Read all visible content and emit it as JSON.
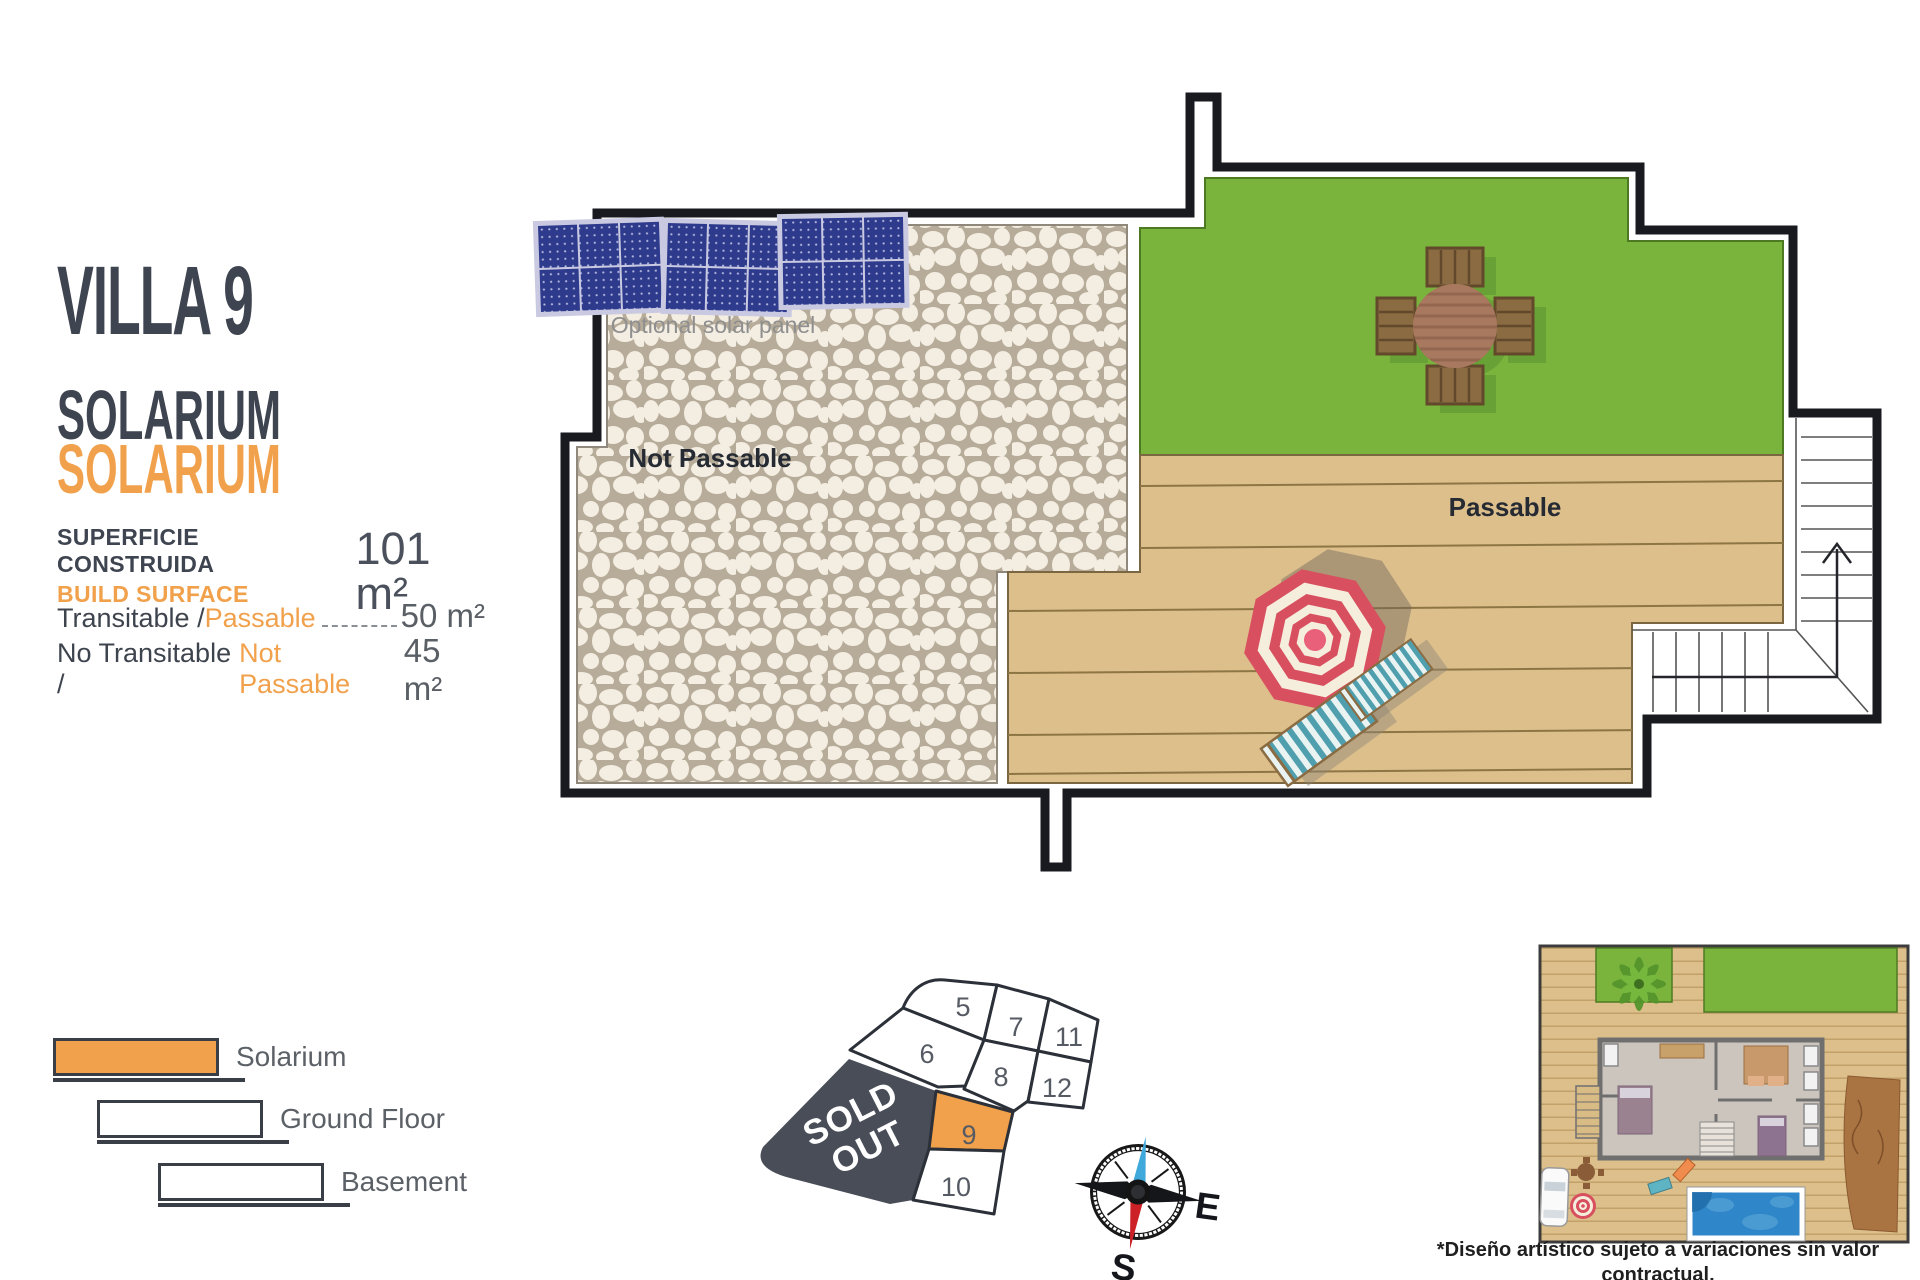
{
  "info_panel": {
    "title": "VILLA 9",
    "subtitle_primary": "SOLARIUM",
    "subtitle_accent": "SOLARIUM",
    "build_surface_label_es": "SUPERFICIE CONSTRUIDA",
    "build_surface_label_en": "BUILD SURFACE",
    "build_surface_value": "101 m²",
    "areas": [
      {
        "label_es": "Transitable / ",
        "label_en": "Passable",
        "value": "50 m²"
      },
      {
        "label_es": "No Transitable / ",
        "label_en": "Not Passable",
        "value": "45 m²"
      }
    ]
  },
  "floor_plan": {
    "optional_solar_panel_label": "Optional solar panel",
    "not_passable_label": "Not Passable",
    "passable_label": "Passable"
  },
  "legend": {
    "items": [
      {
        "label": "Solarium",
        "filled": true
      },
      {
        "label": "Ground Floor",
        "filled": false
      },
      {
        "label": "Basement",
        "filled": false
      }
    ]
  },
  "plot_map": {
    "sold_out_line1": "SOLD",
    "sold_out_line2": "OUT",
    "plots": [
      {
        "number": "5"
      },
      {
        "number": "6"
      },
      {
        "number": "7"
      },
      {
        "number": "8"
      },
      {
        "number": "9",
        "highlighted": true
      },
      {
        "number": "10"
      },
      {
        "number": "11"
      },
      {
        "number": "12"
      }
    ]
  },
  "compass": {
    "east_label": "E",
    "south_label": "S"
  },
  "footnote": {
    "line1": "*Diseño artístico sujeto a variaciones sin valor contractual.",
    "line2": "Muebles y paneles solares no incluidos."
  },
  "colors": {
    "accent_orange": "#F1A14B",
    "dark_text": "#3E4450",
    "plan_green": "#7AB43D",
    "deck_tan": "#DDBF8C",
    "sold_out_gray": "#484D58",
    "solar_panel_blue": "#2E3A8C",
    "umbrella_red": "#D8505F",
    "umbrella_cream": "#F6EEDD",
    "compass_blue": "#3FA9DC",
    "compass_red": "#CC2127"
  }
}
